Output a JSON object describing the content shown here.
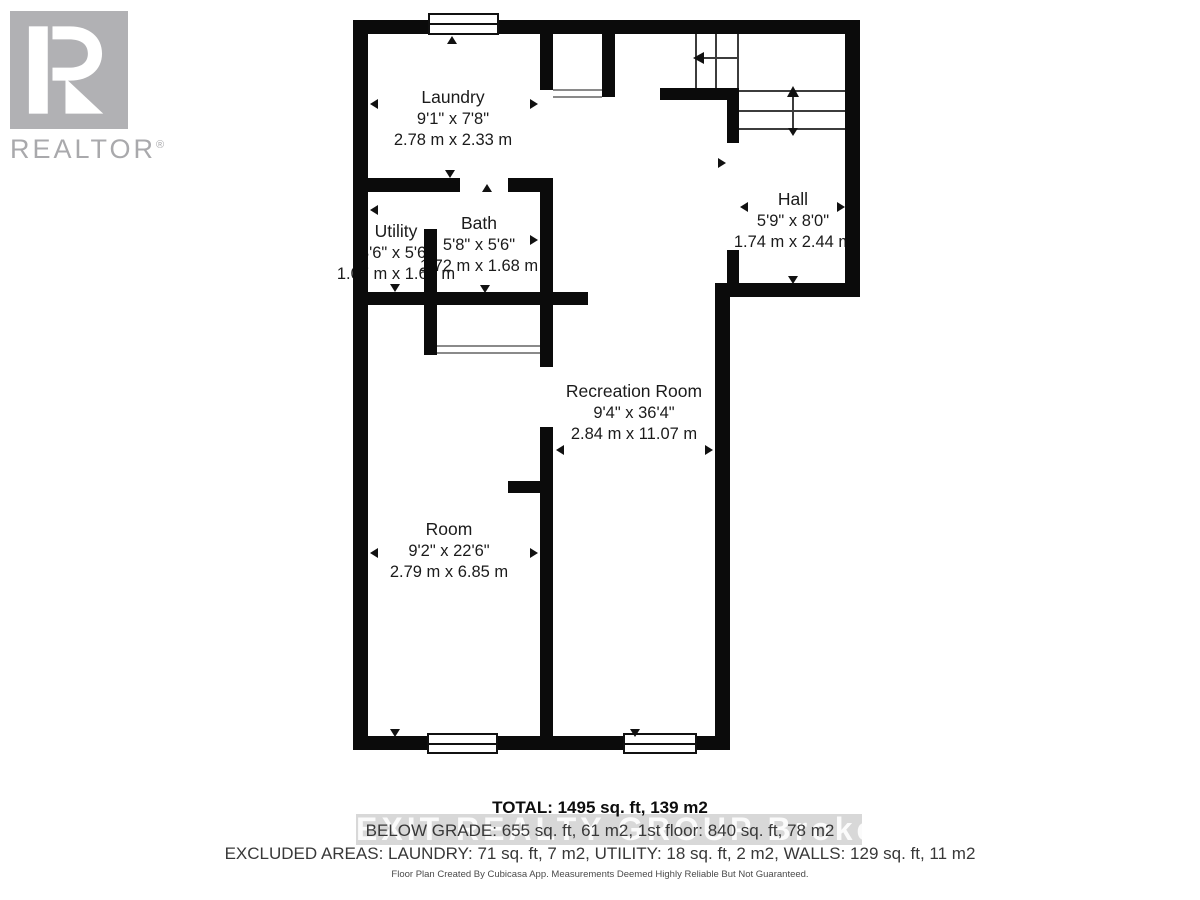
{
  "logo": {
    "brand": "REALTOR",
    "registered": "®"
  },
  "rooms": [
    {
      "id": "laundry",
      "name": "Laundry",
      "imperial": "9'1\" x 7'8\"",
      "metric": "2.78 m x 2.33 m"
    },
    {
      "id": "utility",
      "name": "Utility",
      "imperial": "3'6\" x 5'6\"",
      "metric": "1.07 m x 1.68 m"
    },
    {
      "id": "bath",
      "name": "Bath",
      "imperial": "5'8\" x 5'6\"",
      "metric": "1.72 m x 1.68 m"
    },
    {
      "id": "hall",
      "name": "Hall",
      "imperial": "5'9\" x 8'0\"",
      "metric": "1.74 m x 2.44 m"
    },
    {
      "id": "recreation",
      "name": "Recreation Room",
      "imperial": "9'4\" x 36'4\"",
      "metric": "2.84 m x 11.07 m"
    },
    {
      "id": "room",
      "name": "Room",
      "imperial": "9'2\" x 22'6\"",
      "metric": "2.79 m x 6.85 m"
    }
  ],
  "summary": {
    "total": "TOTAL: 1495 sq. ft, 139 m2",
    "grades": "BELOW GRADE: 655 sq. ft, 61 m2, 1st floor: 840 sq. ft, 78 m2",
    "excluded": "EXCLUDED AREAS: LAUNDRY: 71 sq. ft, 7 m2, UTILITY: 18 sq. ft, 2 m2, WALLS: 129 sq. ft, 11 m2"
  },
  "disclaimer": "Floor Plan Created By Cubicasa App. Measurements Deemed Highly Reliable But Not Guaranteed.",
  "watermark": "EXIT REALTY GROUP Brokerage",
  "colors": {
    "wall": "#0b0b0b",
    "logo_gray": "#b1b1b4",
    "watermark_band": "#d8d8d8"
  }
}
